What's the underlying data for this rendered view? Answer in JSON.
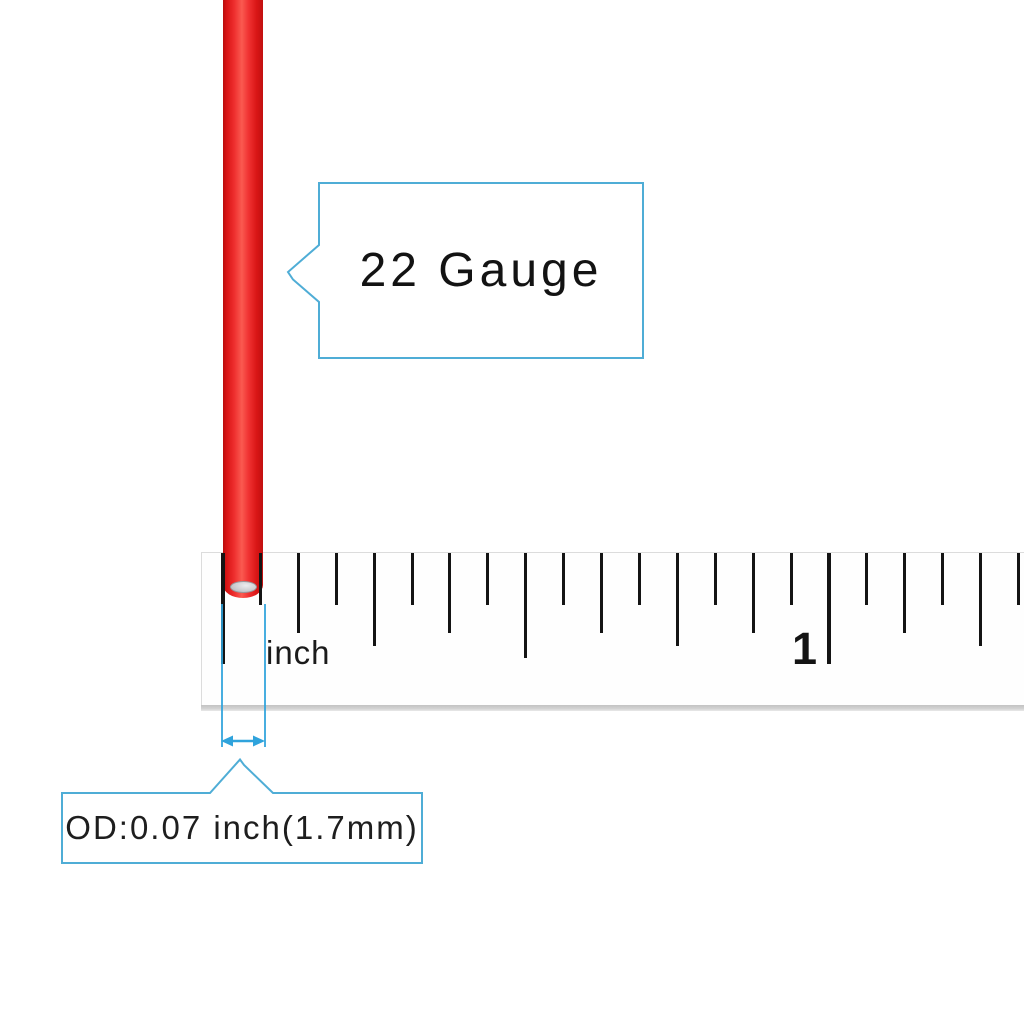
{
  "diagram": {
    "description": "Red 22-gauge wire shown against an inch ruler with outside-diameter callout",
    "background": "#ffffff"
  },
  "wire": {
    "label": "red insulated wire",
    "insulation_dark": "#c20d0d",
    "insulation_bright": "#fa5a50",
    "core_color": "#cdcdd1"
  },
  "callouts": {
    "gauge_label": "22 Gauge",
    "od_label": "OD:0.07 inch(1.7mm)",
    "accent_color": "#4fadd6",
    "guide_color": "#2fa3dc"
  },
  "ruler": {
    "unit_label": "inch",
    "major_label": "1",
    "tick_color": "#141414",
    "start_x": 222.5,
    "sixteenth_spacing_px": 37.9,
    "tick_count": 22,
    "tick_lengths_px": {
      "sixteenth": 52,
      "eighth": 80,
      "quarter": 93,
      "half": 105,
      "inch": 111
    }
  }
}
